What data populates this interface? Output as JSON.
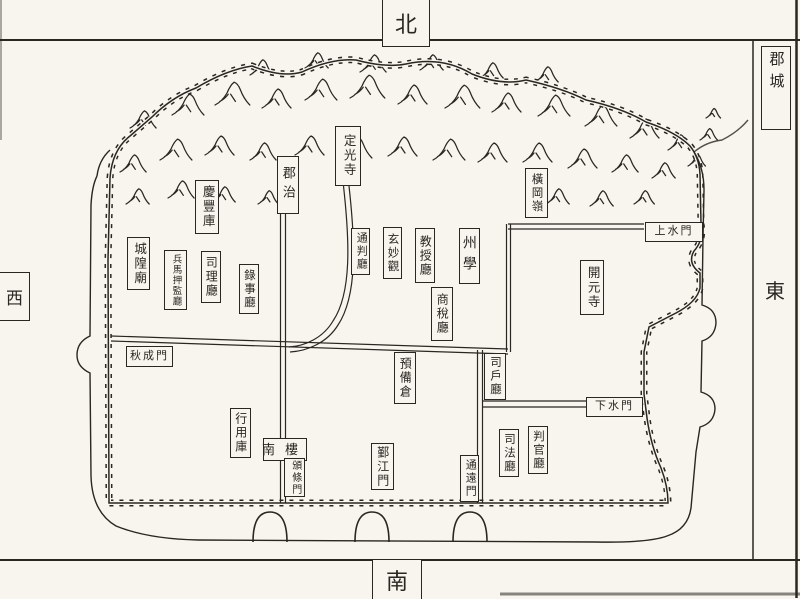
{
  "colors": {
    "paper": "#f7f5ee",
    "ink": "#2a2621"
  },
  "compass": {
    "north": "北",
    "south": "南",
    "west": "西",
    "east": "東",
    "corner_region": "郡城"
  },
  "places": [
    {
      "id": "dingguang-temple",
      "text": "定光寺",
      "x": 335,
      "y": 126,
      "w": 24,
      "h": 58,
      "dir": "v",
      "fs": 12.5
    },
    {
      "id": "prefecture-seat",
      "text": "郡治",
      "x": 277,
      "y": 156,
      "w": 20,
      "h": 56,
      "dir": "v",
      "fs": 13,
      "ls": 6
    },
    {
      "id": "henggang-ridge",
      "text": "橫岡嶺",
      "x": 525,
      "y": 168,
      "w": 21,
      "h": 48,
      "dir": "v",
      "fs": 11.5
    },
    {
      "id": "qingfeng-storehouse",
      "text": "慶豐庫",
      "x": 195,
      "y": 180,
      "w": 22,
      "h": 52,
      "dir": "v",
      "fs": 12.5
    },
    {
      "id": "city-god-temple",
      "text": "城隍廟",
      "x": 127,
      "y": 237,
      "w": 21,
      "h": 51,
      "dir": "v",
      "fs": 12.5
    },
    {
      "id": "military-commissioner-office",
      "text": "兵馬押監廳",
      "x": 164,
      "y": 250,
      "w": 21,
      "h": 58,
      "dir": "v",
      "fs": 9.5,
      "ls": 1
    },
    {
      "id": "sili-office",
      "text": "司理廳",
      "x": 201,
      "y": 251,
      "w": 18,
      "h": 50,
      "dir": "v",
      "fs": 12
    },
    {
      "id": "registrar-office",
      "text": "錄事廳",
      "x": 239,
      "y": 264,
      "w": 18,
      "h": 48,
      "dir": "v",
      "fs": 11.5
    },
    {
      "id": "tongpan-office",
      "text": "通判廳",
      "x": 351,
      "y": 228,
      "w": 17,
      "h": 45,
      "dir": "v",
      "fs": 11
    },
    {
      "id": "xuanmiao-abbey",
      "text": "玄妙觀",
      "x": 383,
      "y": 227,
      "w": 17,
      "h": 50,
      "dir": "v",
      "fs": 11.5
    },
    {
      "id": "professor-office",
      "text": "教授廳",
      "x": 415,
      "y": 228,
      "w": 18,
      "h": 53,
      "dir": "v",
      "fs": 12
    },
    {
      "id": "prefectural-school",
      "text": "州學",
      "x": 459,
      "y": 228,
      "w": 19,
      "h": 54,
      "dir": "v",
      "fs": 14,
      "ls": 7
    },
    {
      "id": "commercial-tax-office",
      "text": "商稅廳",
      "x": 431,
      "y": 287,
      "w": 20,
      "h": 52,
      "dir": "v",
      "fs": 12
    },
    {
      "id": "kaiyuan-temple",
      "text": "開元寺",
      "x": 580,
      "y": 260,
      "w": 22,
      "h": 53,
      "dir": "v",
      "fs": 12.5
    },
    {
      "id": "reserve-granary",
      "text": "預備倉",
      "x": 394,
      "y": 352,
      "w": 20,
      "h": 50,
      "dir": "v",
      "fs": 12
    },
    {
      "id": "sihu-office",
      "text": "司戶廳",
      "x": 484,
      "y": 353,
      "w": 20,
      "h": 45,
      "dir": "v",
      "fs": 11.5
    },
    {
      "id": "circulating-treasury",
      "text": "行用庫",
      "x": 230,
      "y": 408,
      "w": 19,
      "h": 48,
      "dir": "v",
      "fs": 12
    },
    {
      "id": "south-tower",
      "text": "南樓",
      "x": 263,
      "y": 438,
      "w": 42,
      "h": 21,
      "dir": "h",
      "fs": 13,
      "ls": 10
    },
    {
      "id": "bantiao-gate",
      "text": "頒條門",
      "x": 284,
      "y": 458,
      "w": 19,
      "h": 37,
      "dir": "v",
      "fs": 10
    },
    {
      "id": "yinjiang-gate",
      "text": "鄞江門",
      "x": 371,
      "y": 443,
      "w": 21,
      "h": 45,
      "dir": "v",
      "fs": 12
    },
    {
      "id": "tongyuan-gate",
      "text": "通遠門",
      "x": 460,
      "y": 455,
      "w": 17,
      "h": 45,
      "dir": "v",
      "fs": 11
    },
    {
      "id": "justice-office",
      "text": "司法廳",
      "x": 499,
      "y": 429,
      "w": 18,
      "h": 46,
      "dir": "v",
      "fs": 11.5
    },
    {
      "id": "judge-office",
      "text": "判官廳",
      "x": 528,
      "y": 426,
      "w": 18,
      "h": 46,
      "dir": "v",
      "fs": 11.5
    },
    {
      "id": "upper-water-gate",
      "text": "上水門",
      "x": 645,
      "y": 222,
      "w": 56,
      "h": 18,
      "dir": "h",
      "fs": 11
    },
    {
      "id": "lower-water-gate",
      "text": "下水門",
      "x": 586,
      "y": 397,
      "w": 55,
      "h": 18,
      "dir": "h",
      "fs": 11
    },
    {
      "id": "qiucheng-gate",
      "text": "秋成門",
      "x": 126,
      "y": 346,
      "w": 45,
      "h": 19,
      "dir": "h",
      "fs": 11
    }
  ]
}
